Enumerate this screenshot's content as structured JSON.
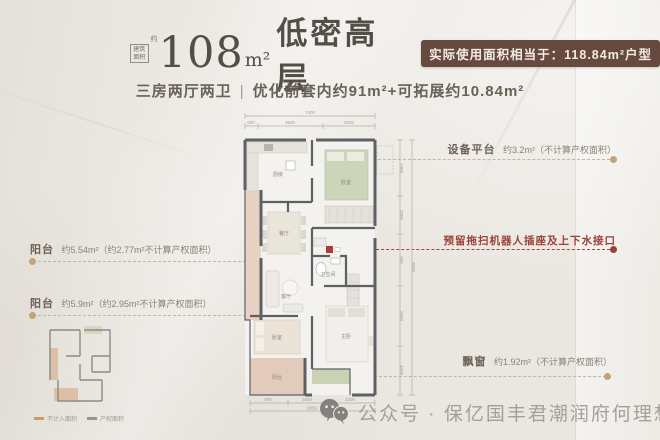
{
  "header": {
    "area_box_line1": "建筑",
    "area_box_line2": "面积",
    "area_approx": "约",
    "area_number": "108",
    "area_unit": "m²",
    "title_cn": "低密高层",
    "badge": "实际使用面积相当于：118.84m²户型",
    "subtitle_left": "三房两厅两卫",
    "subtitle_sep": "|",
    "subtitle_right": "优化前套内约91m²+可拓展约10.84m²"
  },
  "annotations": {
    "left_top": {
      "label": "阳台",
      "value": "约5.54m²（约2.77m²不计算产权面积）"
    },
    "left_bottom": {
      "label": "阳台",
      "value": "约5.9m²（约2.95m²不计算产权面积）"
    },
    "right_top": {
      "label": "设备平台",
      "value": "约3.2m²（不计算产权面积）"
    },
    "right_mid": {
      "label": "预留拖扫机器人插座及上下水接口"
    },
    "right_bottom": {
      "label": "飘窗",
      "value": "约1.92m²（不计算产权面积）"
    }
  },
  "floorplan": {
    "rooms": {
      "kitchen": "厨房",
      "dining": "餐厅",
      "living": "客厅",
      "bedroom_top": "卧室",
      "bath": "卫生间",
      "bedroom_bottom": "卧室",
      "master": "主卧",
      "balcony_left": "阳台",
      "balcony_bottom": "阳台"
    },
    "dims_top": {
      "total": "7400",
      "seg1": "900",
      "seg2": "3500",
      "seg3": "3000"
    },
    "dims_bottom": {
      "total": "6850",
      "seg1": "900",
      "seg2": "3000",
      "seg3": "3300"
    },
    "dims_right": {
      "d1": "1800",
      "d2": "2000",
      "d3": "900",
      "d4": "2000",
      "d5": "4000",
      "total": "9500"
    }
  },
  "keyplan_legend": {
    "item1": "不计入面积",
    "item2": "产权面积"
  },
  "footer": {
    "wechat_text": "公众号 · 保亿国丰君潮润府何理想"
  },
  "colors": {
    "badge_bg": "#664a3f",
    "accent_red": "#9c3f35",
    "dot_tan": "#c2a478",
    "wall": "#5f6066",
    "bed_green": "#ccd5ba",
    "balcony_pink": "#e3c7b6"
  }
}
